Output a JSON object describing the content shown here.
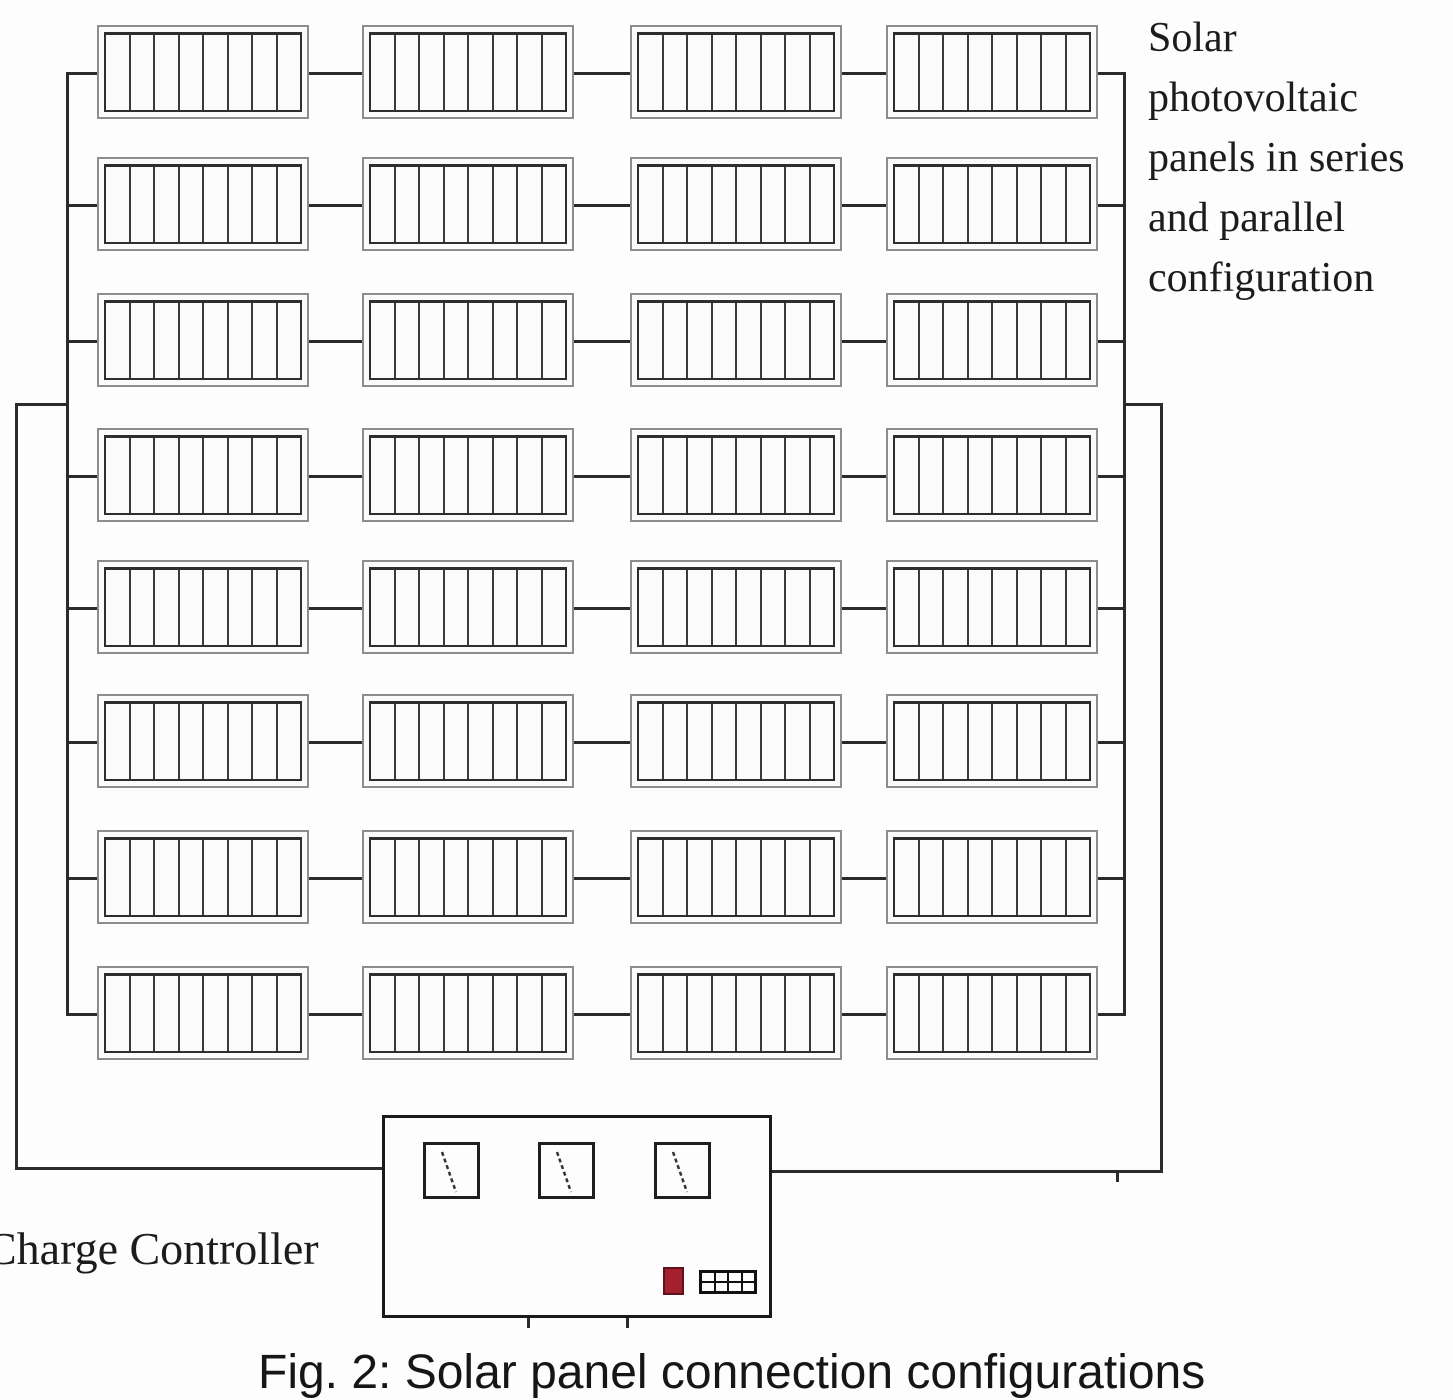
{
  "figure": {
    "caption": "Fig. 2: Solar panel connection configurations"
  },
  "array": {
    "rows": 8,
    "columns": 4,
    "cells_per_panel": 8,
    "label_lines": [
      "Solar",
      "photovoltaic",
      "panels in series",
      "and parallel",
      "configuration"
    ]
  },
  "charge_controller": {
    "label": "Charge Controller",
    "meter_count": 3,
    "indicator_color": "#a3212e",
    "grid_icon": {
      "rows": 2,
      "columns": 4
    }
  },
  "colors": {
    "wire": "#2b2b2b",
    "panel_frame": "#8d8d8d",
    "panel_inner": "#2e2e2e",
    "text": "#1c1c1c"
  }
}
